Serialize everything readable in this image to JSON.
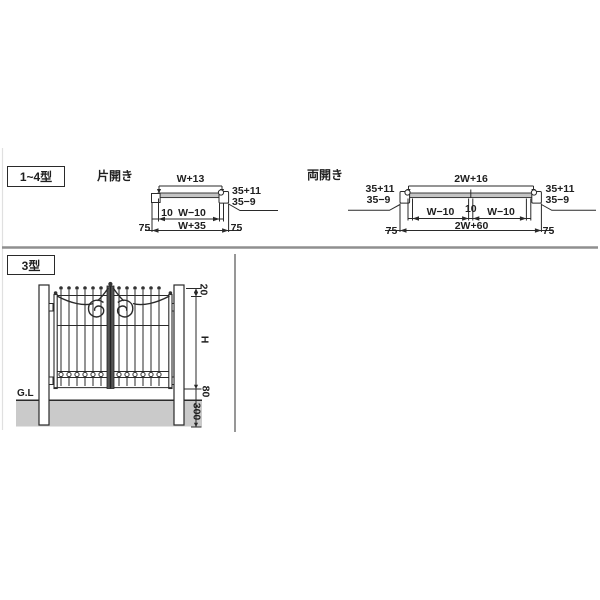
{
  "colors": {
    "line": "#2a2a2a",
    "divider": "#8f8f8f",
    "ground_fill": "#cacaca",
    "plan_bar_fill": "#c4c4c4",
    "section_rule": "#7d7d7d"
  },
  "top_section": {
    "series_box": "1~4型",
    "single": {
      "title": "片開き",
      "dim_width_top": "W+13",
      "dim_frame_a": "35+11",
      "dim_frame_b": "35−9",
      "dim_gap": "10",
      "dim_clear": "W−10",
      "dim_overall": "W+35",
      "dim_post_left": "75",
      "dim_post_right": "75"
    },
    "double": {
      "title": "両開き",
      "dim_width_top": "2W+16",
      "dim_frame_a_left": "35+11",
      "dim_frame_b_left": "35−9",
      "dim_frame_a_right": "35+11",
      "dim_frame_b_right": "35−9",
      "dim_clear_left": "W−10",
      "dim_gap": "10",
      "dim_clear_right": "W−10",
      "dim_overall": "2W+60",
      "dim_post_left": "75",
      "dim_post_right": "75"
    }
  },
  "bottom_section": {
    "model_box": "3型",
    "ground_label": "G.L",
    "dim_top_offset": "20",
    "dim_height": "H",
    "dim_bottom_gap": "80",
    "dim_embed_depth": "300"
  }
}
